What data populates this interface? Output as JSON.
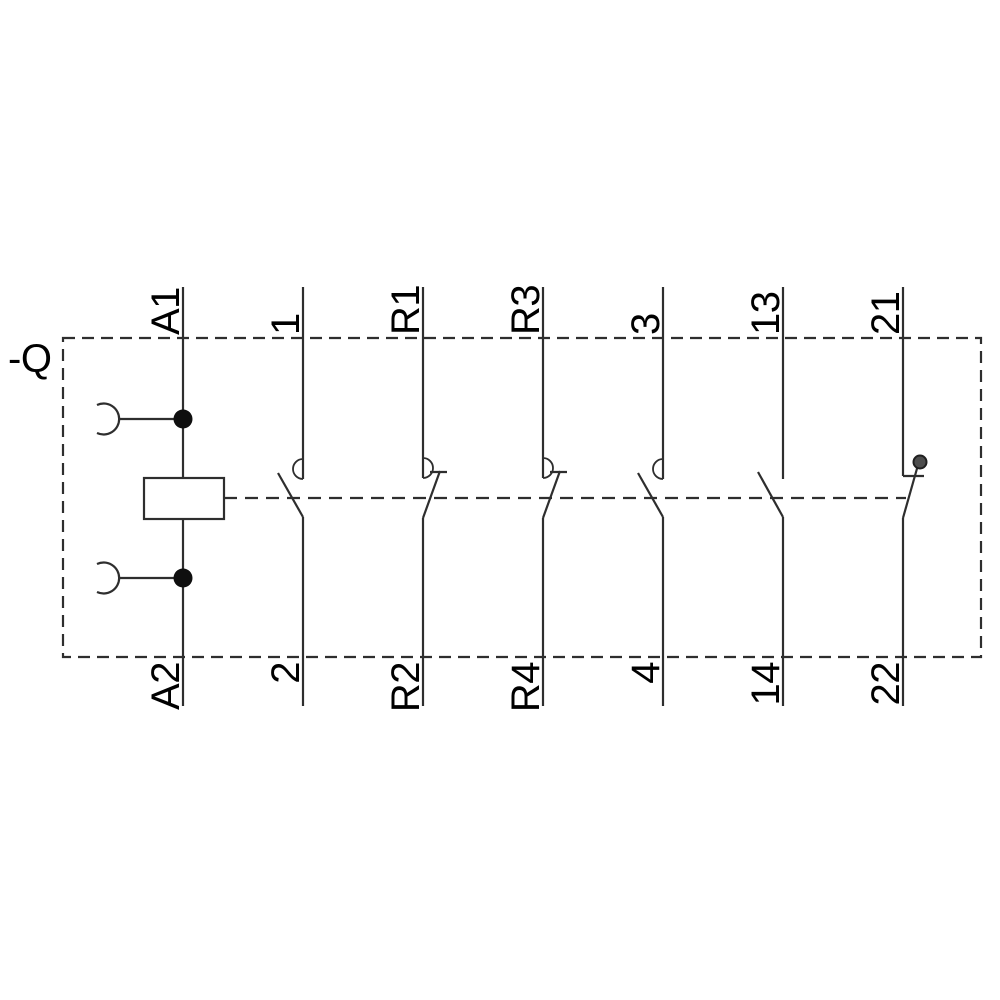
{
  "device_label": "-Q",
  "diagram_type": "contactor-relay-wiring-schematic",
  "colors": {
    "line": "#2e2e2e",
    "text": "#000000",
    "junction_dot": "#0f0f0f",
    "pivot_dot": "#4d4d4d",
    "background": "#ffffff"
  },
  "terminals": [
    {
      "top_label": "A1",
      "bottom_label": "A2",
      "element": "coil"
    },
    {
      "top_label": "1",
      "bottom_label": "2",
      "element": "no-contact-with-arc"
    },
    {
      "top_label": "R1",
      "bottom_label": "R2",
      "element": "nc-contact-with-arc"
    },
    {
      "top_label": "R3",
      "bottom_label": "R4",
      "element": "nc-contact-with-arc"
    },
    {
      "top_label": "3",
      "bottom_label": "4",
      "element": "no-contact-with-arc"
    },
    {
      "top_label": "13",
      "bottom_label": "14",
      "element": "no-contact"
    },
    {
      "top_label": "21",
      "bottom_label": "22",
      "element": "nc-contact-with-pivot"
    }
  ]
}
